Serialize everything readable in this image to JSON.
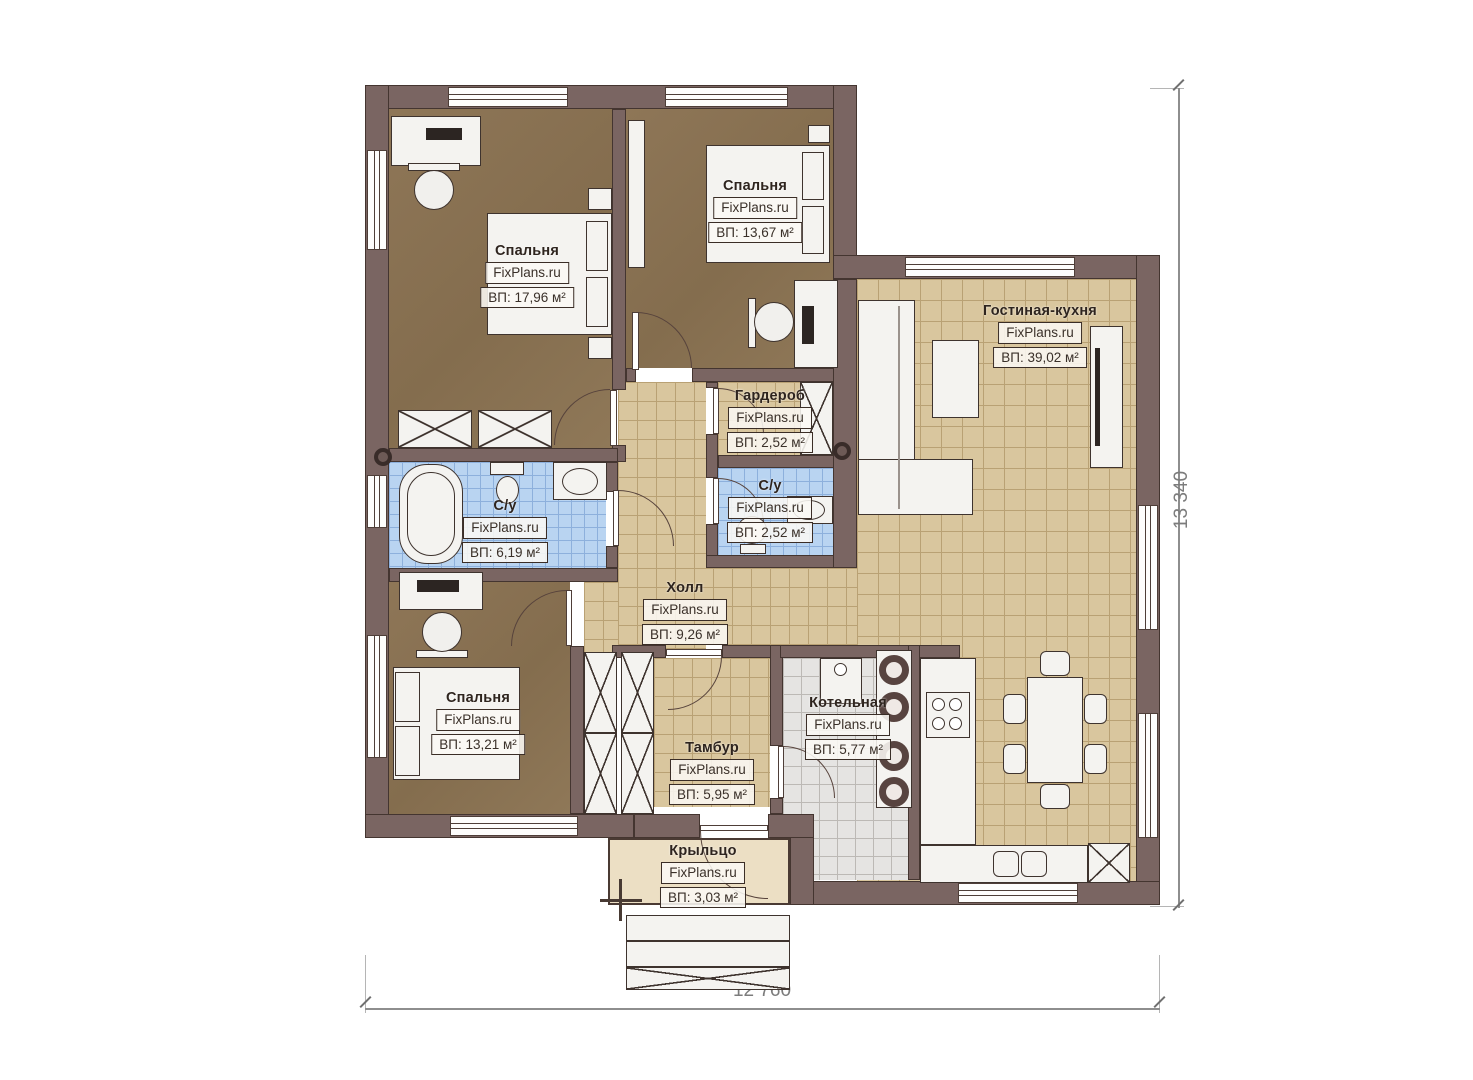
{
  "watermark": "FixPlans.ru",
  "rooms": [
    {
      "id": "bedroom-1",
      "name": "Спальня",
      "area_label": "ВП: 17,96 м²"
    },
    {
      "id": "bedroom-2",
      "name": "Спальня",
      "area_label": "ВП: 13,67 м²"
    },
    {
      "id": "living-kitchen",
      "name": "Гостиная-кухня",
      "area_label": "ВП: 39,02 м²"
    },
    {
      "id": "wardrobe",
      "name": "Гардероб",
      "area_label": "ВП: 2,52 м²"
    },
    {
      "id": "bathroom-main",
      "name": "С/у",
      "area_label": "ВП: 6,19 м²"
    },
    {
      "id": "bathroom-small",
      "name": "С/у",
      "area_label": "ВП: 2,52 м²"
    },
    {
      "id": "hall",
      "name": "Холл",
      "area_label": "ВП: 9,26 м²"
    },
    {
      "id": "bedroom-3",
      "name": "Спальня",
      "area_label": "ВП: 13,21 м²"
    },
    {
      "id": "vestibule",
      "name": "Тамбур",
      "area_label": "ВП: 5,95 м²"
    },
    {
      "id": "boiler-room",
      "name": "Котельная",
      "area_label": "ВП: 5,77 м²"
    },
    {
      "id": "porch",
      "name": "Крыльцо",
      "area_label": "ВП: 3,03 м²"
    }
  ],
  "dimensions": {
    "width_mm": "12 760",
    "height_mm": "13 340"
  },
  "colors": {
    "wall": "#7a6562",
    "bedroom_floor": "#8a7355",
    "tile_floor": "#d9c69e",
    "bath_floor": "#b9d4f1",
    "boiler_floor": "#e5e4e2",
    "porch_floor": "#ecdfc4"
  }
}
